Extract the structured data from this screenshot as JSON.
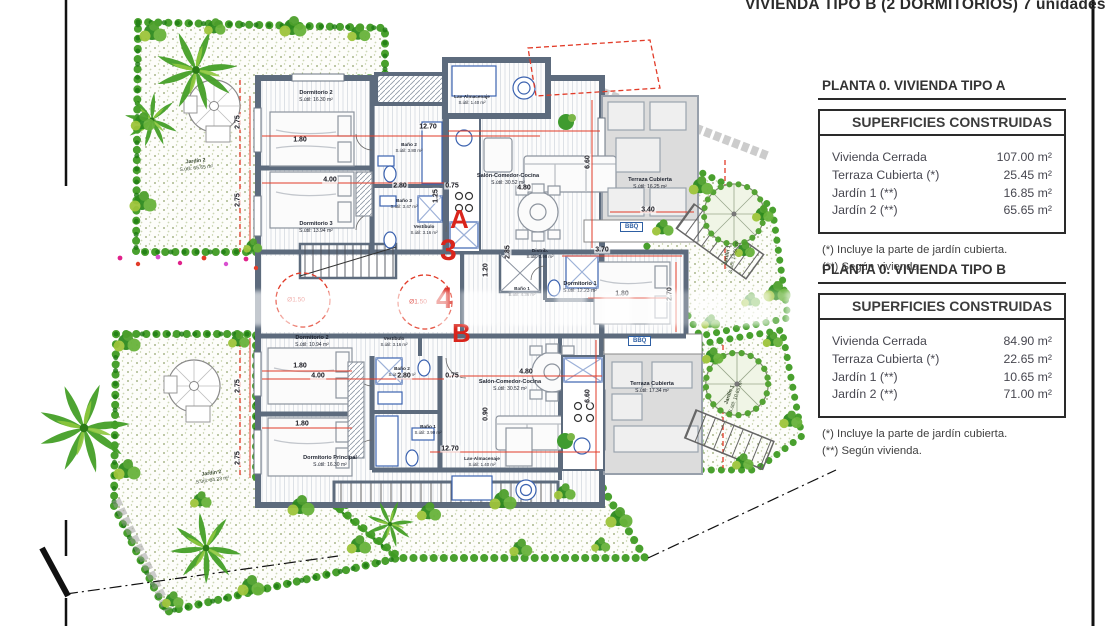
{
  "header": {
    "title": "VIVIENDA TIPO B (2 DORMITORIOS) 7 unidades"
  },
  "panels": [
    {
      "title": "PLANTA 0. VIVIENDA TIPO A",
      "table_title": "SUPERFICIES CONSTRUIDAS",
      "rows": [
        {
          "label": "Vivienda Cerrada",
          "value": "107.00 m²"
        },
        {
          "label": "Terraza Cubierta  (*)",
          "value": "25.45 m²"
        },
        {
          "label": "Jardín 1 (**)",
          "value": "16.85 m²"
        },
        {
          "label": "Jardín 2 (**)",
          "value": "65.65 m²"
        }
      ],
      "notes": [
        "(*)  Incluye la parte de jardín cubierta.",
        "(**) Según vivienda."
      ]
    },
    {
      "title": "PLANTA 0. VIVIENDA TIPO B",
      "table_title": "SUPERFICIES CONSTRUIDAS",
      "rows": [
        {
          "label": "Vivienda Cerrada",
          "value": "84.90 m²"
        },
        {
          "label": "Terraza Cubierta (*)",
          "value": "22.65 m²"
        },
        {
          "label": "Jardín 1 (**)",
          "value": "10.65 m²"
        },
        {
          "label": "Jardín 2 (**)",
          "value": "71.00 m²"
        }
      ],
      "notes": [
        "(*) Incluye la parte de jardín cubierta.",
        "(**) Según vivienda."
      ]
    }
  ],
  "plan": {
    "units": {
      "a": "A",
      "b": "B",
      "n3": "3",
      "n4": "4"
    },
    "bbq": "BBQ",
    "circle_label": "Ø1.50",
    "rooms": {
      "a_dorm2": {
        "name": "Dormitorio 2",
        "area": "S.útil: 16.30 m²"
      },
      "a_dorm3": {
        "name": "Dormitorio 3",
        "area": "S.útil: 13.94 m²"
      },
      "a_bano2": {
        "name": "Baño 2",
        "area": "S.útil: 3.80 m²"
      },
      "a_bano3": {
        "name": "Baño 3",
        "area": "S.útil: 3.47 m²"
      },
      "a_vestibulo": {
        "name": "Vestíbulo",
        "area": "S.útil: 3.16 m²"
      },
      "a_lav": {
        "name": "Lav-Almacenaje",
        "area": "S.útil: 1.40 m²"
      },
      "a_salon": {
        "name": "Salón-Comedor-Cocina",
        "area": "S.útil: 30.52 m²"
      },
      "a_terraza": {
        "name": "Terraza Cubierta",
        "area": "S.útil: 16.25 m²"
      },
      "a_distrib": {
        "name": "Distrib.",
        "area": "S.útil: 0.98 m²"
      },
      "a_dorm1": {
        "name": "Dormitorio 1",
        "area": "S.útil: 12.23 m²"
      },
      "a_bano1": {
        "name": "Baño 1",
        "area": "S.útil: 4.36 m²"
      },
      "b_dorm2": {
        "name": "Dormitorio 2",
        "area": "S.útil: 10.94 m²"
      },
      "b_vestibulo": {
        "name": "Vestíbulo",
        "area": "S.útil: 3.16 m²"
      },
      "b_bano2": {
        "name": "Baño 2",
        "area": "S.útil: 3.47 m²"
      },
      "b_bano1": {
        "name": "Baño 1",
        "area": "S.útil: 3.90 m²"
      },
      "b_dormp": {
        "name": "Dormitorio Principal",
        "area": "S.útil: 16.30 m²"
      },
      "b_lav": {
        "name": "Lav-Almacenaje",
        "area": "S.útil: 1.40 m²"
      },
      "b_salon": {
        "name": "Salón-Comedor-Cocina",
        "area": "S.útil: 30.52 m²"
      },
      "b_terraza": {
        "name": "Terraza Cubierta",
        "area": "S.útil: 17.34 m²"
      },
      "jardin2_top": {
        "name": "Jardín 2",
        "area": "S.útil: 65.65 m²"
      },
      "jardin2_bottom": {
        "name": "Jardín 2",
        "area": "S.útil: 84.23 m²"
      },
      "jardin1_right": {
        "name": "Jardín 1",
        "area": "S.útil: 14.50 m²"
      },
      "jardin1_bottom": {
        "name": "Jardín 1",
        "area": "S.útil: 10.65 m²"
      }
    },
    "dims": [
      "2.75",
      "1.80",
      "4.00",
      "2.75",
      "12.70",
      "2.80",
      "1.25",
      "0.75",
      "4.80",
      "6.60",
      "3.40",
      "3.70",
      "1.80",
      "2.70",
      "2.85",
      "1.80",
      "4.00",
      "2.80",
      "0.75",
      "4.80",
      "2.75",
      "1.80",
      "2.75",
      "12.70",
      "6.60",
      "0.90",
      "1.20"
    ]
  }
}
